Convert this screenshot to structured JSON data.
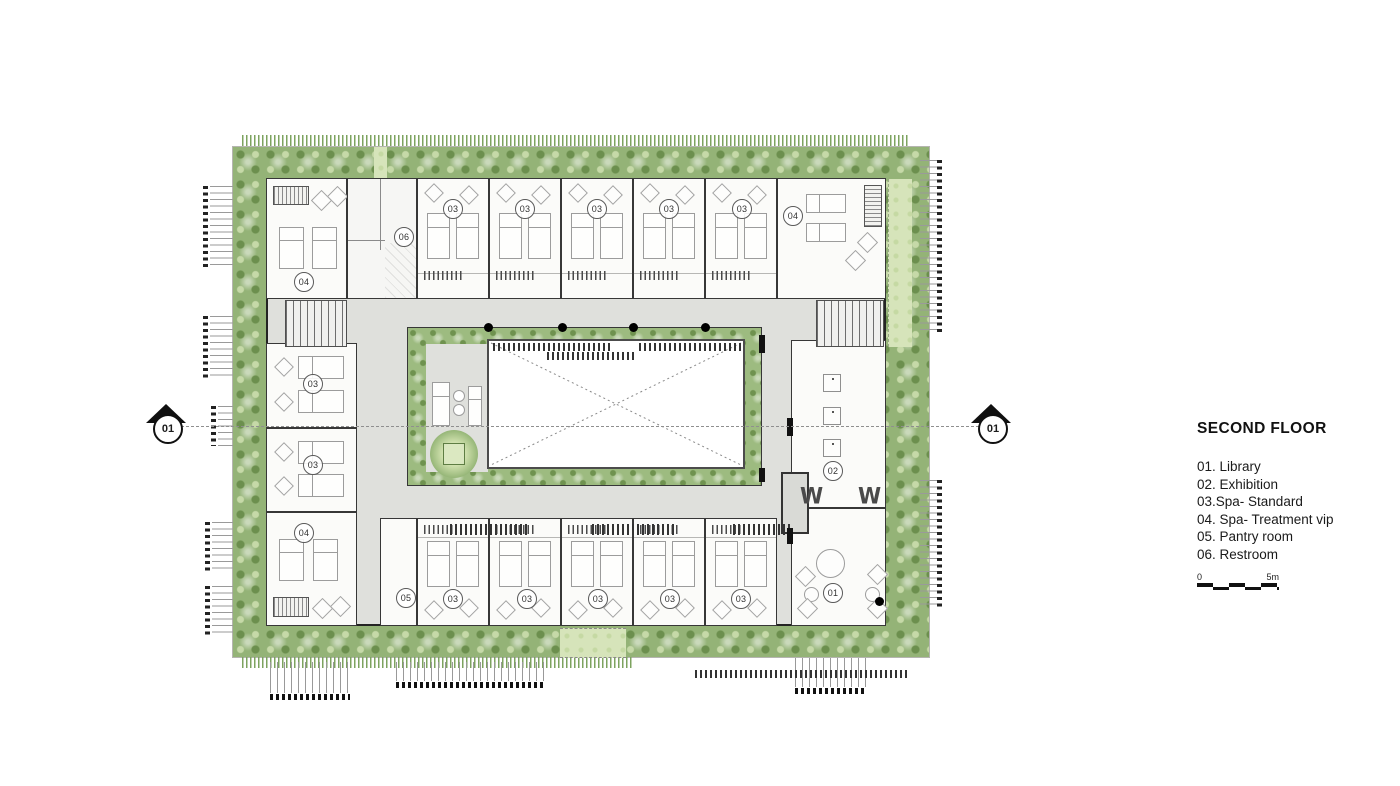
{
  "legend": {
    "title": "SECOND FLOOR",
    "items": [
      "01. Library",
      "02. Exhibition",
      "03.Spa- Standard",
      "04. Spa- Treatment vip",
      "05. Pantry room",
      "06. Restroom"
    ],
    "scale_start": "0",
    "scale_end": "5m"
  },
  "section_markers": {
    "left": "01",
    "right": "01"
  },
  "plan": {
    "labels": [
      {
        "room": "spa-treatment-vip",
        "text": "04"
      },
      {
        "room": "restroom",
        "text": "06"
      },
      {
        "room": "spa-standard",
        "text": "03"
      },
      {
        "room": "spa-standard",
        "text": "03"
      },
      {
        "room": "spa-standard",
        "text": "03"
      },
      {
        "room": "spa-standard",
        "text": "03"
      },
      {
        "room": "spa-standard",
        "text": "03"
      },
      {
        "room": "spa-treatment-vip",
        "text": "04"
      },
      {
        "room": "spa-standard",
        "text": "03"
      },
      {
        "room": "spa-standard",
        "text": "03"
      },
      {
        "room": "spa-treatment-vip",
        "text": "04"
      },
      {
        "room": "pantry-room",
        "text": "05"
      },
      {
        "room": "spa-standard",
        "text": "03"
      },
      {
        "room": "spa-standard",
        "text": "03"
      },
      {
        "room": "spa-standard",
        "text": "03"
      },
      {
        "room": "spa-standard",
        "text": "03"
      },
      {
        "room": "spa-standard",
        "text": "03"
      },
      {
        "room": "exhibition",
        "text": "02"
      },
      {
        "room": "library",
        "text": "01"
      }
    ],
    "wall_letters": [
      "W",
      "W"
    ]
  },
  "colors": {
    "tree_green": "#94b377",
    "lawn_green": "#d6e4ba",
    "floor_gray": "#dfe0dc",
    "wall_dark": "#242424"
  }
}
